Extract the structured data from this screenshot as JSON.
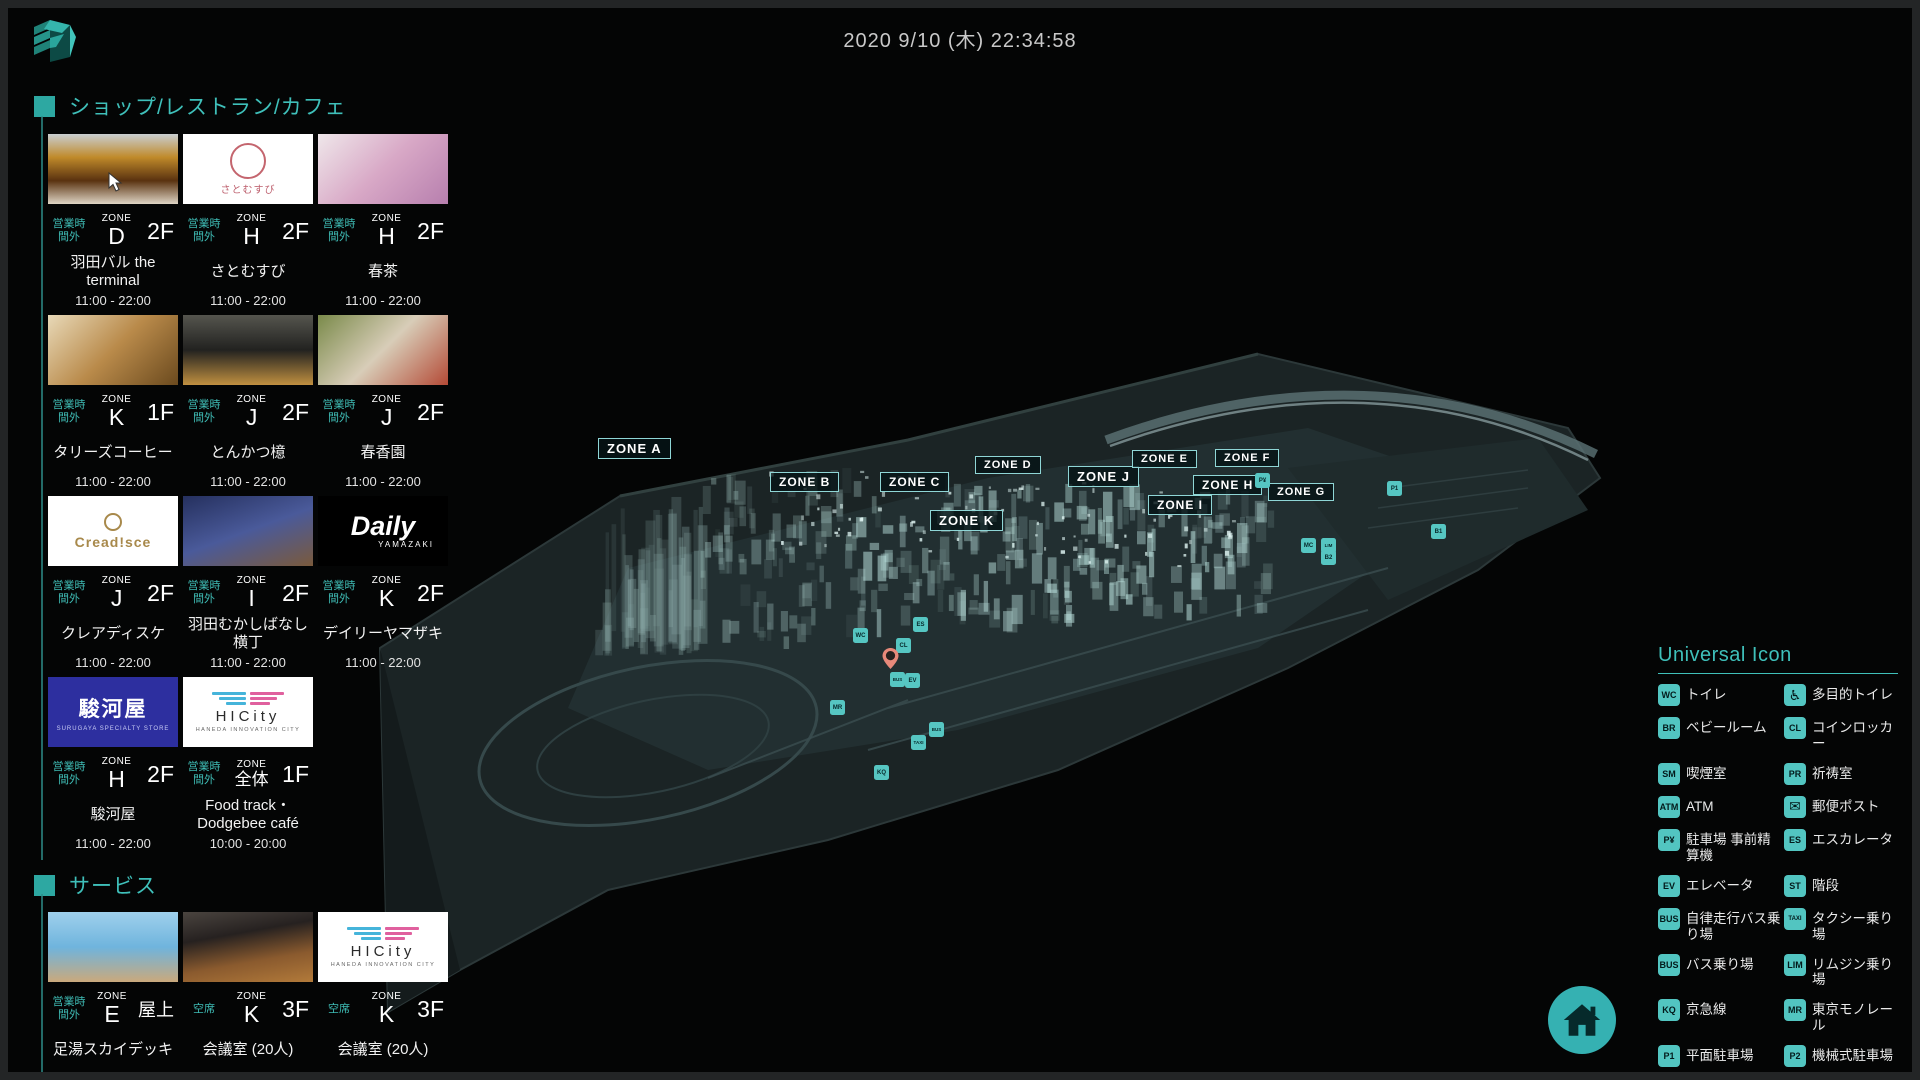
{
  "header": {
    "clock": "2020 9/10 (木) 22:34:58"
  },
  "shops_section": {
    "title": "ショップ/レストラン/カフェ"
  },
  "services_section": {
    "title": "サービス"
  },
  "shops": [
    {
      "name": "羽田バル the terminal",
      "status": "営業時間外",
      "zone": "D",
      "floor": "2F",
      "hours": "11:00 - 22:00",
      "thumb": {
        "type": "photo",
        "angle": 180,
        "colors": [
          "#c9ced1",
          "#c08a2a",
          "#5a3210",
          "#ded5c5"
        ]
      }
    },
    {
      "name": "さとむすび",
      "status": "営業時間外",
      "zone": "H",
      "floor": "2F",
      "hours": "11:00 - 22:00",
      "thumb": {
        "type": "logo",
        "logo": "satomusubi",
        "text": "さとむすび",
        "color": "#bd5f6d"
      }
    },
    {
      "name": "春茶",
      "status": "営業時間外",
      "zone": "H",
      "floor": "2F",
      "hours": "11:00 - 22:00",
      "thumb": {
        "type": "photo",
        "angle": 135,
        "colors": [
          "#efe7ea",
          "#d8a8c6",
          "#b77fae"
        ]
      }
    },
    {
      "name": "タリーズコーヒー",
      "status": "営業時間外",
      "zone": "K",
      "floor": "1F",
      "hours": "11:00 - 22:00",
      "thumb": {
        "type": "photo",
        "angle": 135,
        "colors": [
          "#e8d9b8",
          "#b98a4a",
          "#6b4a1e"
        ]
      }
    },
    {
      "name": "とんかつ檍",
      "status": "営業時間外",
      "zone": "J",
      "floor": "2F",
      "hours": "11:00 - 22:00",
      "thumb": {
        "type": "photo",
        "angle": 180,
        "colors": [
          "#55554e",
          "#222220",
          "#c09040"
        ]
      }
    },
    {
      "name": "春香園",
      "status": "営業時間外",
      "zone": "J",
      "floor": "2F",
      "hours": "11:00 - 22:00",
      "thumb": {
        "type": "photo",
        "angle": 135,
        "colors": [
          "#7a8a4a",
          "#d8cdb8",
          "#b44a36"
        ]
      }
    },
    {
      "name": "クレアディスケ",
      "status": "営業時間外",
      "zone": "J",
      "floor": "2F",
      "hours": "11:00 - 22:00",
      "thumb": {
        "type": "logo",
        "logo": "creadisce",
        "text": "Cread!sce",
        "color": "#a8894b"
      }
    },
    {
      "name": "羽田むかしばなし横丁",
      "status": "営業時間外",
      "zone": "I",
      "floor": "2F",
      "hours": "11:00 - 22:00",
      "thumb": {
        "type": "photo",
        "angle": 160,
        "colors": [
          "#25305e",
          "#4a5a9a",
          "#7a5a3c"
        ]
      }
    },
    {
      "name": "デイリーヤマザキ",
      "status": "営業時間外",
      "zone": "K",
      "floor": "2F",
      "hours": "11:00 - 22:00",
      "thumb": {
        "type": "logo",
        "logo": "daily",
        "text": "Daily",
        "sub": "YAMAZAKI",
        "color": "#ffffff"
      }
    },
    {
      "name": "駿河屋",
      "status": "営業時間外",
      "zone": "H",
      "floor": "2F",
      "hours": "11:00 - 22:00",
      "thumb": {
        "type": "logo",
        "logo": "surugaya",
        "text": "駿河屋",
        "sub": "SURUGAYA SPECIALTY STORE",
        "bg": "#2d2f9f"
      }
    },
    {
      "name": "Food track・Dodgebee café",
      "status": "営業時間外",
      "zone": "全体",
      "floor": "1F",
      "hours": "10:00 - 20:00",
      "thumb": {
        "type": "logo",
        "logo": "hicity",
        "text": "HICity",
        "sub": "HANEDA INNOVATION CITY",
        "c1": "#45b4da",
        "c2": "#e0609e"
      }
    }
  ],
  "services": [
    {
      "name": "足湯スカイデッキ",
      "status": "営業時間外",
      "zone": "E",
      "floor": "屋上",
      "thumb": {
        "type": "photo",
        "angle": 180,
        "colors": [
          "#9fd0ec",
          "#6fb4dd",
          "#caa97c"
        ]
      }
    },
    {
      "name": "会議室 (20人)",
      "status": "空席",
      "zone": "K",
      "floor": "3F",
      "thumb": {
        "type": "photo",
        "angle": 170,
        "colors": [
          "#4a443f",
          "#262120",
          "#8a5a2e",
          "#b27a3a"
        ]
      }
    },
    {
      "name": "会議室 (20人)",
      "status": "空席",
      "zone": "K",
      "floor": "3F",
      "thumb": {
        "type": "logo",
        "logo": "hicity",
        "text": "HICity",
        "sub": "HANEDA INNOVATION CITY",
        "c1": "#45b4da",
        "c2": "#e0609e"
      }
    }
  ],
  "map": {
    "zones": [
      {
        "label": "ZONE A",
        "x": 590,
        "y": 430,
        "fs": 13
      },
      {
        "label": "ZONE B",
        "x": 762,
        "y": 464,
        "fs": 12
      },
      {
        "label": "ZONE C",
        "x": 872,
        "y": 464,
        "fs": 12
      },
      {
        "label": "ZONE D",
        "x": 967,
        "y": 448,
        "fs": 11
      },
      {
        "label": "ZONE J",
        "x": 1060,
        "y": 458,
        "fs": 13
      },
      {
        "label": "ZONE E",
        "x": 1124,
        "y": 442,
        "fs": 11
      },
      {
        "label": "ZONE F",
        "x": 1207,
        "y": 441,
        "fs": 11
      },
      {
        "label": "ZONE H",
        "x": 1185,
        "y": 467,
        "fs": 12
      },
      {
        "label": "ZONE G",
        "x": 1260,
        "y": 475,
        "fs": 11
      },
      {
        "label": "ZONE I",
        "x": 1140,
        "y": 487,
        "fs": 12
      },
      {
        "label": "ZONE K",
        "x": 922,
        "y": 502,
        "fs": 13
      }
    ],
    "icons": [
      {
        "name": "toilet",
        "glyph": "WC",
        "x": 845,
        "y": 620
      },
      {
        "name": "escalator",
        "glyph": "ES",
        "x": 905,
        "y": 609
      },
      {
        "name": "coin-locker",
        "glyph": "CL",
        "x": 888,
        "y": 630
      },
      {
        "name": "autonomous-bus-stop",
        "glyph": "BUS",
        "x": 882,
        "y": 664
      },
      {
        "name": "elevator",
        "glyph": "EV",
        "x": 897,
        "y": 665
      },
      {
        "name": "tokyo-monorail",
        "glyph": "MR",
        "x": 822,
        "y": 692
      },
      {
        "name": "bus-stop",
        "glyph": "BUS",
        "x": 921,
        "y": 714
      },
      {
        "name": "taxi-stand",
        "glyph": "TAXI",
        "x": 903,
        "y": 727
      },
      {
        "name": "keikyu-line",
        "glyph": "KQ",
        "x": 866,
        "y": 757
      },
      {
        "name": "parking-pay-machine",
        "glyph": "P¥",
        "x": 1247,
        "y": 465
      },
      {
        "name": "flat-parking",
        "glyph": "P1",
        "x": 1379,
        "y": 473
      },
      {
        "name": "bicycle-parking-1",
        "glyph": "B1",
        "x": 1423,
        "y": 516
      },
      {
        "name": "motorcycle-parking",
        "glyph": "MC",
        "x": 1293,
        "y": 530
      },
      {
        "name": "limousine-stop",
        "glyph": "LIM",
        "x": 1313,
        "y": 530
      },
      {
        "name": "bicycle-parking-2",
        "glyph": "B2",
        "x": 1313,
        "y": 542
      }
    ],
    "pin": {
      "x": 874,
      "y": 640
    }
  },
  "legend": {
    "title": "Universal Icon",
    "items": [
      {
        "name": "toilet",
        "glyph": "WC",
        "label": "トイレ"
      },
      {
        "name": "accessible-toilet",
        "glyph": "♿",
        "label": "多目的トイレ"
      },
      {
        "name": "baby-room",
        "glyph": "BR",
        "label": "ベビールーム"
      },
      {
        "name": "coin-locker",
        "glyph": "CL",
        "label": "コインロッカー"
      },
      {
        "name": "smoking-room",
        "glyph": "SM",
        "label": "喫煙室"
      },
      {
        "name": "prayer-room",
        "glyph": "PR",
        "label": "祈祷室"
      },
      {
        "name": "atm",
        "glyph": "ATM",
        "label": "ATM"
      },
      {
        "name": "post-box",
        "glyph": "✉",
        "label": "郵便ポスト"
      },
      {
        "name": "parking-pay-machine",
        "glyph": "P¥",
        "label": "駐車場 事前精算機"
      },
      {
        "name": "escalator",
        "glyph": "ES",
        "label": "エスカレータ"
      },
      {
        "name": "elevator",
        "glyph": "EV",
        "label": "エレベータ"
      },
      {
        "name": "stairs",
        "glyph": "ST",
        "label": "階段"
      },
      {
        "name": "autonomous-bus-stop",
        "glyph": "BUS",
        "label": "自律走行バス乗り場"
      },
      {
        "name": "taxi-stand",
        "glyph": "TAXI",
        "label": "タクシー乗り場"
      },
      {
        "name": "bus-stop",
        "glyph": "BUS",
        "label": "バス乗り場"
      },
      {
        "name": "limousine-stop",
        "glyph": "LIM",
        "label": "リムジン乗り場"
      },
      {
        "name": "keikyu-line",
        "glyph": "KQ",
        "label": "京急線"
      },
      {
        "name": "tokyo-monorail",
        "glyph": "MR",
        "label": "東京モノレール"
      },
      {
        "name": "flat-parking",
        "glyph": "P1",
        "label": "平面駐車場"
      },
      {
        "name": "mechanical-parking",
        "glyph": "P2",
        "label": "機械式駐車場"
      },
      {
        "name": "bicycle-parking-1",
        "glyph": "B1",
        "label": "駐輪場1"
      },
      {
        "name": "bicycle-parking-2",
        "glyph": "B2",
        "label": "駐輪場2"
      },
      {
        "name": "motorcycle-parking",
        "glyph": "MC",
        "label": "バイク置き場"
      }
    ]
  },
  "colors": {
    "accent": "#3fbdb6",
    "legend_icon": "#52c5c1",
    "zone_border": "#8fd6d6",
    "home": "#35b1b2",
    "pin": "#e8897a",
    "building": "#bfe6e2"
  }
}
